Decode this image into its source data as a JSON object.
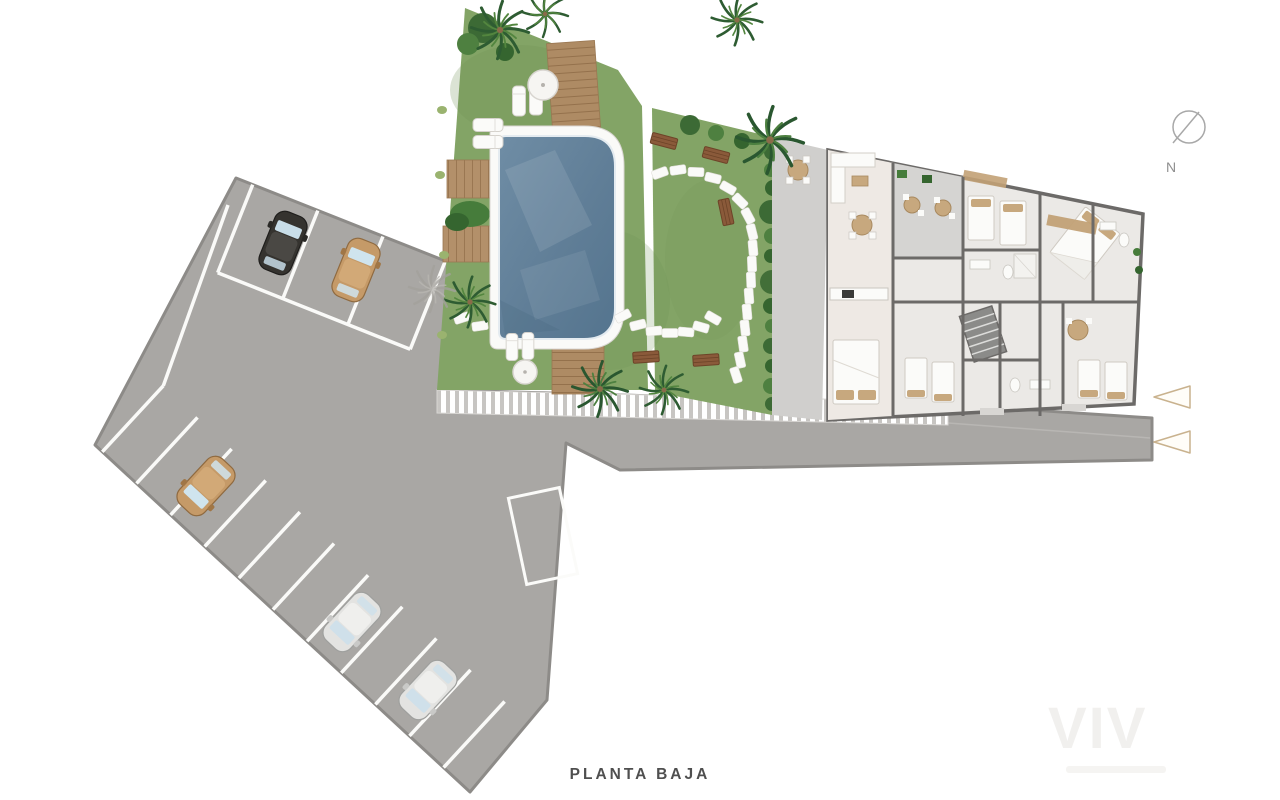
{
  "title": {
    "label": "PLANTA BAJA"
  },
  "compass": {
    "label": "N"
  },
  "watermark": {
    "text": "VIV"
  },
  "legend_arrows": {
    "count": 2,
    "direction": "left",
    "outline_color": "#c9b28e"
  },
  "colors": {
    "background": "#ffffff",
    "asphalt": "#a9a7a4",
    "asphalt_border": "#8d8b88",
    "parking_stripe": "#fafaf8",
    "grass": "#83a466",
    "pool_water": "#607e97",
    "pool_coping": "#fafaf8",
    "deck_wood": "#b3906a",
    "bench_wood": "#8a5a3a",
    "palm_green": "#2e5c32",
    "hedge_green": "#3c6a35",
    "building_wall": "#6c6a68",
    "building_floor": "#ebe9e6",
    "terrace_tile": "#d5d4d2",
    "furniture_tan": "#c7a87e",
    "title_text": "#4f4f4f"
  },
  "site": {
    "cars": [
      {
        "color": "black",
        "area": "upper parking row"
      },
      {
        "color": "tan",
        "area": "upper parking row"
      },
      {
        "color": "tan",
        "area": "lower parking row"
      },
      {
        "color": "silver",
        "area": "lower parking row"
      },
      {
        "color": "silver",
        "area": "lower parking row"
      }
    ],
    "palm_trees": 7,
    "pools": 1,
    "parking_rows": 2,
    "marked_bays_upper": 4,
    "marked_bays_lower": 11
  }
}
